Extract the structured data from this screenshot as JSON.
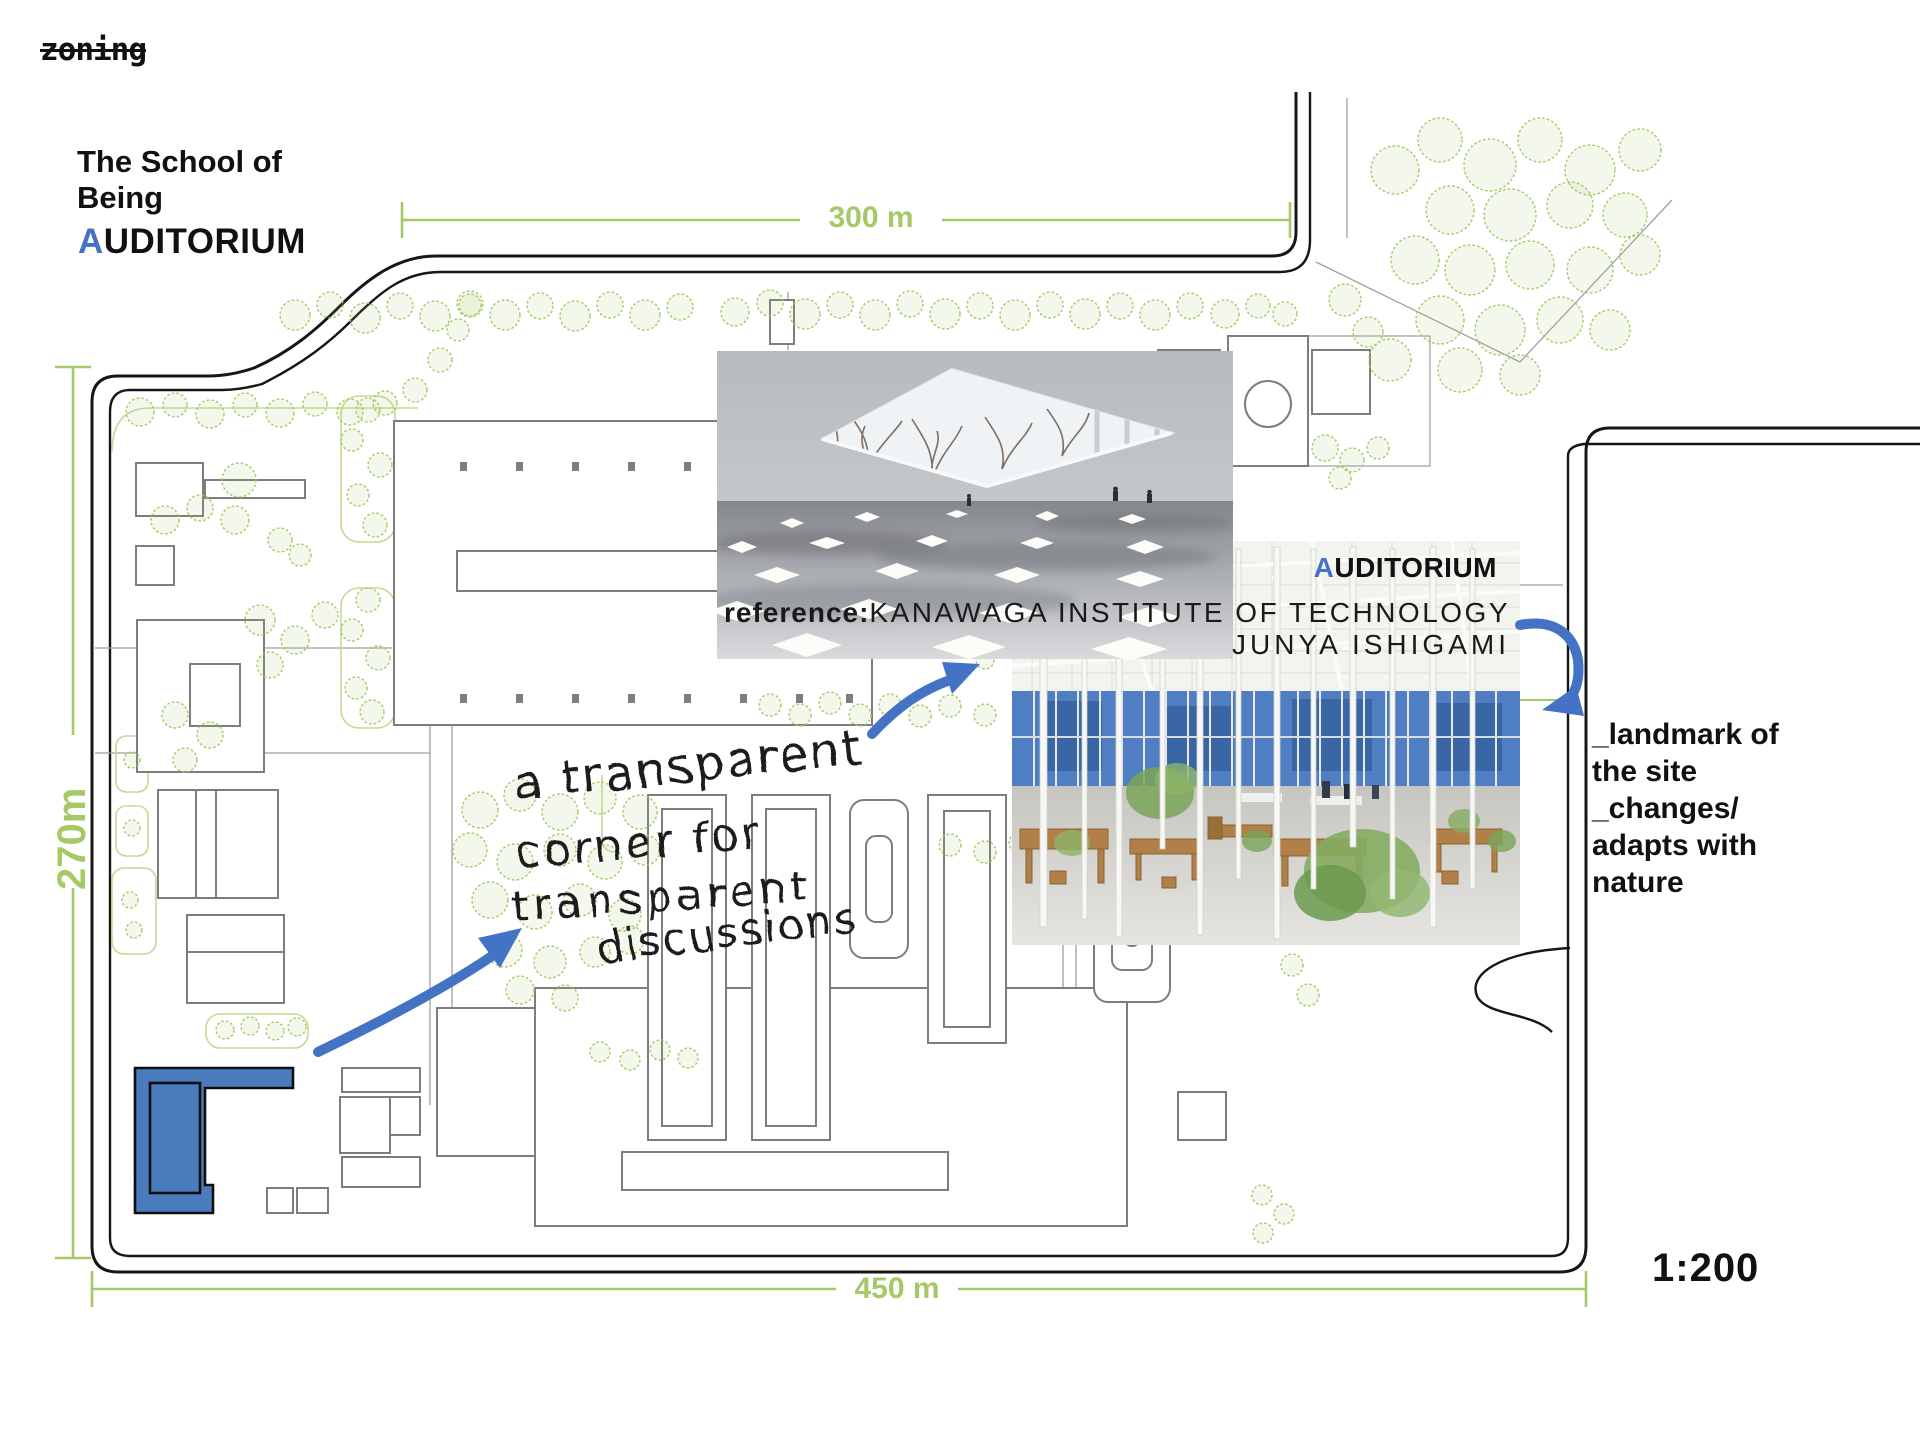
{
  "header": {
    "crossed_label": "zoning",
    "project_line1": "The School of",
    "project_line2": "Being",
    "room_first": "A",
    "room_rest": "UDITORIUM"
  },
  "dimensions": {
    "top": "300 m",
    "left": "270m",
    "bottom": "450 m",
    "scale": "1:200"
  },
  "reference": {
    "label_first": "A",
    "label_rest": "UDITORIUM",
    "caption_prefix": "reference:",
    "caption_name": "KANAWAGA INSTITUTE OF TECHNOLOGY",
    "caption_architect": "JUNYA ISHIGAMI"
  },
  "handwriting": {
    "line1": "a transparent",
    "line2": "corner for",
    "line3": "transparent",
    "line4": "discussions"
  },
  "landmark_note": {
    "line1": "_landmark of",
    "line2": "the site",
    "line3": "_changes/",
    "line4": "adapts with",
    "line5": "nature"
  },
  "colors": {
    "accent_blue": "#4472c4",
    "plan_green": "#a5c966",
    "zone_blue_fill": "#4a7bbd"
  }
}
